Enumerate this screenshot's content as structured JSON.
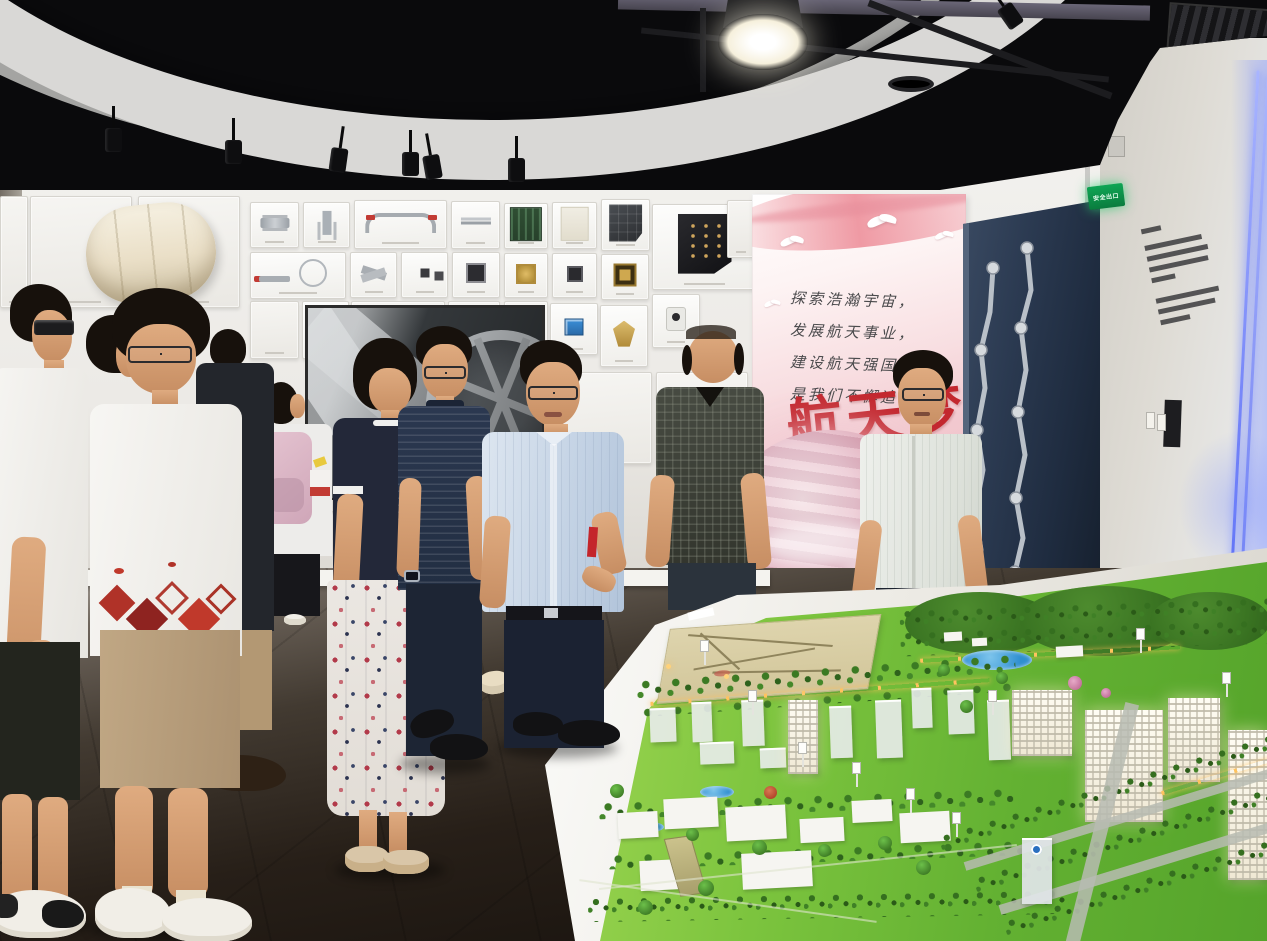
{
  "meta": {
    "scene": "aerospace-exhibition-hall-group-visit"
  },
  "poster": {
    "lines": [
      "探索浩瀚宇宙，",
      "发展航天事业，",
      "建设航天强国，",
      "是我们不懈追求"
    ],
    "calligraphy": "航天梦"
  },
  "signs": {
    "exit": "安全出口"
  },
  "palette": {
    "ceiling": "#0a0a0c",
    "wall": "#eceae6",
    "wall-right": "#dcd9d3",
    "floor-dark": "#1d1813",
    "door": "#24374e",
    "poster-red": "#c3272e",
    "exit-green": "#10a14c",
    "grass": "#76c23d",
    "grass-deep": "#4f9a28",
    "table": "#f3f2ed",
    "led-blue": "#7d8ffb",
    "skin": "#d9a87e",
    "hair": "#17110c"
  },
  "wall_panels": [
    {
      "x": 0,
      "y": 196,
      "w": 28,
      "h": 112,
      "t": "faint"
    },
    {
      "x": 30,
      "y": 196,
      "w": 102,
      "h": 112,
      "t": "faint"
    },
    {
      "x": 138,
      "y": 196,
      "w": 102,
      "h": 112,
      "t": "faint"
    },
    {
      "x": 250,
      "y": 202,
      "w": 49,
      "h": 46,
      "t": "valve"
    },
    {
      "x": 303,
      "y": 202,
      "w": 47,
      "h": 46,
      "t": "tconn"
    },
    {
      "x": 354,
      "y": 200,
      "w": 93,
      "h": 49,
      "t": "handlebar"
    },
    {
      "x": 451,
      "y": 201,
      "w": 49,
      "h": 48,
      "t": "probe"
    },
    {
      "x": 250,
      "y": 252,
      "w": 96,
      "h": 47,
      "t": "cable"
    },
    {
      "x": 350,
      "y": 252,
      "w": 47,
      "h": 46,
      "t": "xconn"
    },
    {
      "x": 401,
      "y": 252,
      "w": 47,
      "h": 46,
      "t": "chips2"
    },
    {
      "x": 452,
      "y": 252,
      "w": 48,
      "h": 46,
      "t": "chipgrid"
    },
    {
      "x": 504,
      "y": 203,
      "w": 44,
      "h": 46,
      "t": "pcb"
    },
    {
      "x": 552,
      "y": 202,
      "w": 45,
      "h": 47,
      "t": "sketch"
    },
    {
      "x": 601,
      "y": 199,
      "w": 49,
      "h": 52,
      "t": "solar"
    },
    {
      "x": 652,
      "y": 204,
      "w": 105,
      "h": 86,
      "t": "blackbox"
    },
    {
      "x": 504,
      "y": 253,
      "w": 44,
      "h": 45,
      "t": "chipgold"
    },
    {
      "x": 552,
      "y": 253,
      "w": 45,
      "h": 45,
      "t": "chipdark"
    },
    {
      "x": 601,
      "y": 254,
      "w": 48,
      "h": 46,
      "t": "chipgold2"
    },
    {
      "x": 504,
      "y": 301,
      "w": 44,
      "h": 58,
      "t": "faint"
    },
    {
      "x": 550,
      "y": 303,
      "w": 48,
      "h": 52,
      "t": "bluemod"
    },
    {
      "x": 600,
      "y": 305,
      "w": 48,
      "h": 62,
      "t": "golddish"
    },
    {
      "x": 652,
      "y": 294,
      "w": 48,
      "h": 54,
      "t": "camdev"
    },
    {
      "x": 250,
      "y": 301,
      "w": 49,
      "h": 58,
      "t": "faint"
    },
    {
      "x": 302,
      "y": 301,
      "w": 47,
      "h": 58,
      "t": "reddot"
    },
    {
      "x": 351,
      "y": 301,
      "w": 94,
      "h": 60,
      "t": "faint"
    },
    {
      "x": 448,
      "y": 301,
      "w": 52,
      "h": 60,
      "t": "faint"
    },
    {
      "x": 448,
      "y": 448,
      "w": 60,
      "h": 62,
      "t": "devices"
    },
    {
      "x": 448,
      "y": 514,
      "w": 60,
      "h": 64,
      "t": "faint"
    },
    {
      "x": 560,
      "y": 372,
      "w": 92,
      "h": 92,
      "t": "faint"
    },
    {
      "x": 656,
      "y": 372,
      "w": 92,
      "h": 92,
      "t": "faint"
    },
    {
      "x": 727,
      "y": 200,
      "w": 28,
      "h": 58,
      "t": "faint"
    }
  ],
  "model": {
    "ghosts": [
      {
        "x": 650,
        "y": 708,
        "w": 26,
        "h": 34
      },
      {
        "x": 692,
        "y": 702,
        "w": 20,
        "h": 40
      },
      {
        "x": 742,
        "y": 700,
        "w": 22,
        "h": 46
      },
      {
        "x": 830,
        "y": 706,
        "w": 22,
        "h": 52
      },
      {
        "x": 876,
        "y": 700,
        "w": 26,
        "h": 58
      },
      {
        "x": 912,
        "y": 688,
        "w": 20,
        "h": 40
      },
      {
        "x": 948,
        "y": 690,
        "w": 26,
        "h": 44
      },
      {
        "x": 700,
        "y": 742,
        "w": 34,
        "h": 22
      },
      {
        "x": 760,
        "y": 748,
        "w": 26,
        "h": 20
      },
      {
        "x": 988,
        "y": 700,
        "w": 22,
        "h": 60
      }
    ],
    "lit_buildings": [
      {
        "x": 788,
        "y": 700,
        "w": 30,
        "h": 74
      },
      {
        "x": 1012,
        "y": 690,
        "w": 60,
        "h": 66
      },
      {
        "x": 1085,
        "y": 710,
        "w": 78,
        "h": 112
      },
      {
        "x": 1168,
        "y": 698,
        "w": 52,
        "h": 84
      },
      {
        "x": 1228,
        "y": 730,
        "w": 39,
        "h": 150
      }
    ],
    "white_buildings": [
      {
        "x": 618,
        "y": 812,
        "w": 40,
        "h": 26
      },
      {
        "x": 664,
        "y": 798,
        "w": 54,
        "h": 30
      },
      {
        "x": 726,
        "y": 806,
        "w": 60,
        "h": 34
      },
      {
        "x": 800,
        "y": 818,
        "w": 44,
        "h": 24
      },
      {
        "x": 852,
        "y": 800,
        "w": 40,
        "h": 22
      },
      {
        "x": 900,
        "y": 812,
        "w": 50,
        "h": 30
      },
      {
        "x": 742,
        "y": 852,
        "w": 70,
        "h": 36
      },
      {
        "x": 640,
        "y": 860,
        "w": 44,
        "h": 30
      },
      {
        "x": 944,
        "y": 632,
        "w": 18,
        "h": 9
      },
      {
        "x": 972,
        "y": 638,
        "w": 15,
        "h": 8
      },
      {
        "x": 1056,
        "y": 646,
        "w": 27,
        "h": 11
      }
    ],
    "trees": [
      {
        "x": 610,
        "y": 784,
        "s": 14
      },
      {
        "x": 686,
        "y": 828,
        "s": 13
      },
      {
        "x": 752,
        "y": 840,
        "s": 15
      },
      {
        "x": 818,
        "y": 844,
        "s": 13
      },
      {
        "x": 878,
        "y": 836,
        "s": 14
      },
      {
        "x": 916,
        "y": 860,
        "s": 15
      },
      {
        "x": 698,
        "y": 880,
        "s": 16
      },
      {
        "x": 638,
        "y": 900,
        "s": 15
      },
      {
        "x": 960,
        "y": 700,
        "s": 13
      },
      {
        "x": 996,
        "y": 672,
        "s": 12
      },
      {
        "x": 938,
        "y": 664,
        "s": 12
      }
    ],
    "signposts": [
      {
        "x": 700,
        "y": 640
      },
      {
        "x": 748,
        "y": 690
      },
      {
        "x": 798,
        "y": 742
      },
      {
        "x": 852,
        "y": 762
      },
      {
        "x": 906,
        "y": 788
      },
      {
        "x": 952,
        "y": 812
      },
      {
        "x": 988,
        "y": 690
      },
      {
        "x": 1136,
        "y": 628
      },
      {
        "x": 1222,
        "y": 672
      }
    ]
  }
}
